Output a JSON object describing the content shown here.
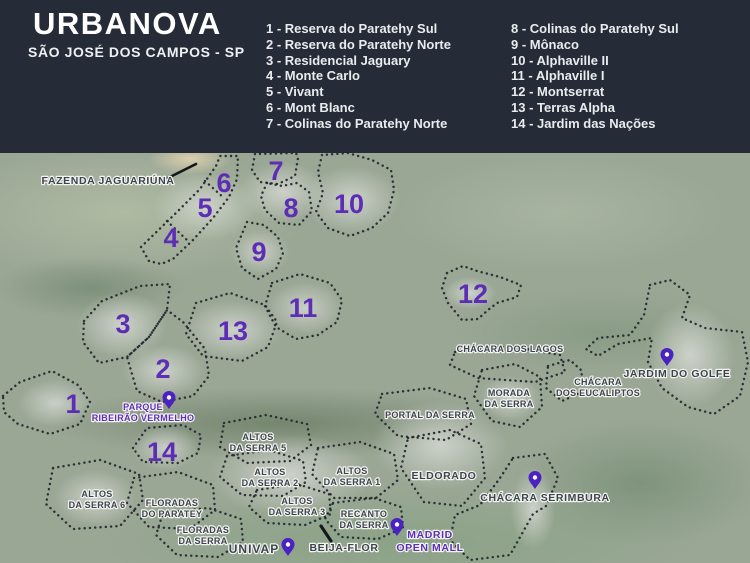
{
  "header": {
    "title": "URBANOVA",
    "subtitle": "SÃO JOSÉ DOS CAMPOS - SP"
  },
  "legend": {
    "column1": [
      "1 - Reserva do Paratehy Sul",
      "2 - Reserva do Paratehy Norte",
      "3 - Residencial Jaguary",
      "4 - Monte Carlo",
      "5 - Vivant",
      "6 - Mont Blanc",
      "7 - Colinas do Paratehy Norte"
    ],
    "column2": [
      "8 - Colinas do Paratehy Sul",
      "9 - Mônaco",
      "10 - Alphaville II",
      "11 - Alphaville I",
      "12 - Montserrat",
      "13 - Terras Alpha",
      "14 - Jardim das Nações"
    ]
  },
  "map": {
    "colors": {
      "header_bg": "#262c37",
      "accent_purple": "#5e2db6",
      "pin_purple": "#4a22c0",
      "label_dark": "#3c434b"
    },
    "numbers": [
      "1",
      "2",
      "3",
      "4",
      "5",
      "6",
      "7",
      "8",
      "9",
      "10",
      "11",
      "12",
      "13",
      "14"
    ],
    "labels": {
      "fazenda_jaguariuna": [
        "FAZENDA JAGUARIÚNA"
      ],
      "chacara_dos_lagos": [
        "CHÁCARA DOS LAGOS"
      ],
      "morada_da_serra": [
        "MORADA",
        "DA SERRA"
      ],
      "chacara_dos_eucaliptos": [
        "CHÁCARA",
        "DOS EUCALIPTOS"
      ],
      "jardim_do_golfe": [
        "JARDIM DO GOLFE"
      ],
      "portal_da_serra": [
        "PORTAL DA SERRA"
      ],
      "eldorado": [
        "ELDORADO"
      ],
      "chacara_serimbura": [
        "CHÁCARA SERIMBURA"
      ],
      "altos_da_serra_5": [
        "ALTOS",
        "DA SERRA 5"
      ],
      "altos_da_serra_2": [
        "ALTOS",
        "DA SERRA 2"
      ],
      "altos_da_serra_1": [
        "ALTOS",
        "DA SERRA 1"
      ],
      "altos_da_serra_6": [
        "ALTOS",
        "DA SERRA 6"
      ],
      "altos_da_serra_3": [
        "ALTOS",
        "DA SERRA 3"
      ],
      "floradas_do_paratey": [
        "FLORADAS",
        "DO PARATEY"
      ],
      "floradas_da_serra": [
        "FLORADAS",
        "DA SERRA"
      ],
      "recanto_da_serra": [
        "RECANTO",
        "DA SERRA"
      ],
      "parque_ribeirao_vermelho": [
        "PARQUE",
        "RIBEIRÃO VERMELHO"
      ],
      "univap": [
        "UNIVAP"
      ],
      "beija_flor": [
        "BEIJA-FLOR"
      ],
      "madrid_open_mall": [
        "MADRID",
        "OPEN MALL"
      ]
    }
  }
}
